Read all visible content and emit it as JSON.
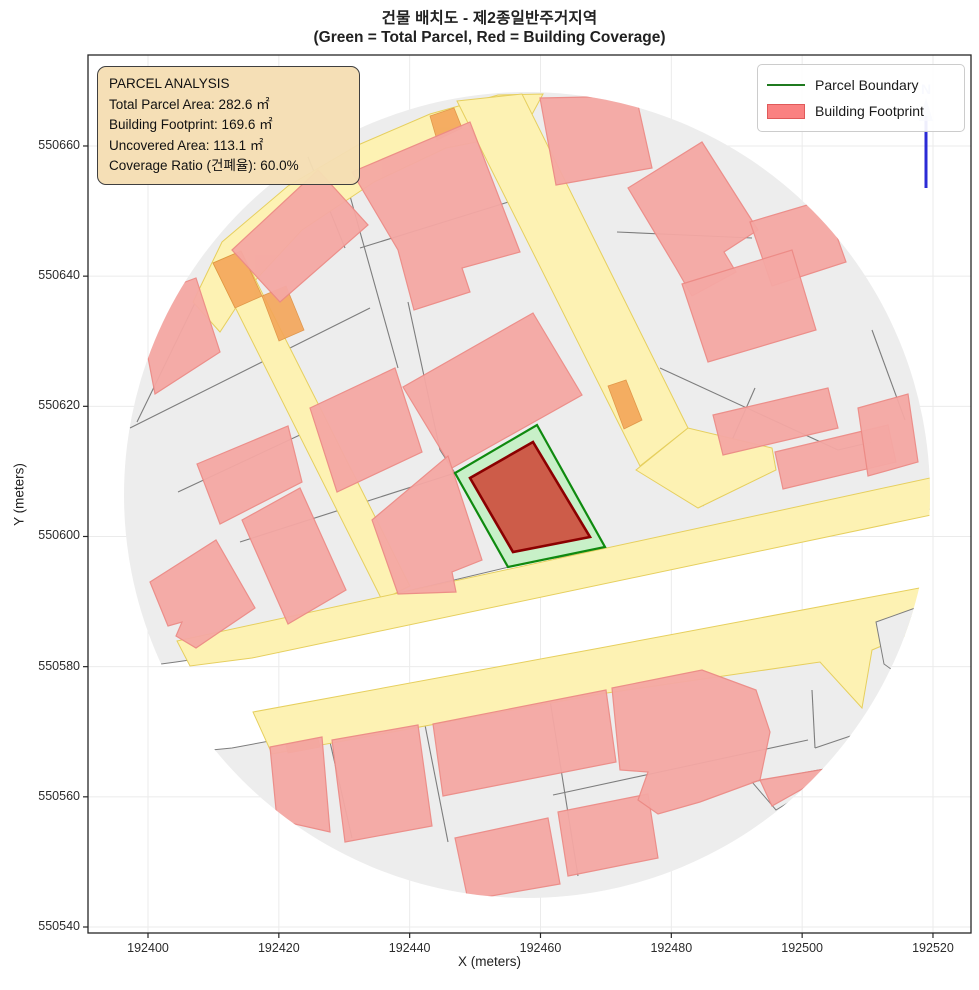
{
  "figure": {
    "title_line1": "건물 배치도 - 제2종일반주거지역",
    "title_line2": "(Green = Total Parcel, Red = Building Coverage)",
    "xlabel": "X (meters)",
    "ylabel": "Y (meters)"
  },
  "legend": {
    "items": [
      {
        "label": "Parcel Boundary",
        "swatch": "green-line"
      },
      {
        "label": "Building Footprint",
        "swatch": "red-patch"
      }
    ]
  },
  "info_box": {
    "title": "PARCEL ANALYSIS",
    "lines": [
      "Total Parcel Area: 282.6 ㎡",
      "Building Footprint: 169.6 ㎡",
      "Uncovered Area: 113.1 ㎡",
      "Coverage Ratio (건폐율): 60.0%"
    ]
  },
  "north_arrow": {
    "label": "N"
  },
  "chart_data": {
    "type": "map",
    "title": "건물 배치도 - 제2종일반주거지역",
    "subtitle": "(Green = Total Parcel, Red = Building Coverage)",
    "xlabel": "X (meters)",
    "ylabel": "Y (meters)",
    "x_ticks": [
      192400,
      192420,
      192440,
      192460,
      192480,
      192500,
      192520
    ],
    "y_ticks": [
      550540,
      550560,
      550580,
      550600,
      550620,
      550640,
      550660
    ],
    "xlim": [
      192391,
      192526
    ],
    "ylim": [
      550539,
      550674
    ],
    "grid": true,
    "legend_position": "upper right",
    "analysis": {
      "total_parcel_area_m2": 282.6,
      "building_footprint_m2": 169.6,
      "uncovered_area_m2": 113.1,
      "coverage_ratio_pct": 60.0,
      "zone": "제2종일반주거지역"
    },
    "map_region": {
      "center_m": [
        192458,
        550606
      ],
      "radius_m": 61.7
    },
    "highlight": {
      "parcel_polygon_m": [
        [
          192459.5,
          550616.9
        ],
        [
          192469.9,
          550598.2
        ],
        [
          192455.1,
          550595.2
        ],
        [
          192447.0,
          550609.6
        ]
      ],
      "building_polygon_m": [
        [
          192458.9,
          550614.3
        ],
        [
          192467.6,
          550599.8
        ],
        [
          192455.9,
          550597.5
        ],
        [
          192449.3,
          550608.8
        ]
      ]
    },
    "style": {
      "building_fill": "#f5a8a4",
      "building_edge": "#ec8a85",
      "parcel_fill": "#ededed",
      "parcel_edge": "#7d7d7d",
      "road_fill": "#fdf2b3",
      "road_edge": "#e6cf5e",
      "orange_fill": "#f4a659",
      "orange_edge": "#de8f3f",
      "highlight_parcel_fill": "#c8f0c8",
      "highlight_parcel_edge": "#0f8a0f",
      "highlight_building_fill": "#cd5c49",
      "highlight_building_edge": "#8b0000",
      "grid_color": "#ebebeb",
      "frame_color": "#262626",
      "north_arrow_color": "#2b2bd6",
      "north_head_color": "#a9b0ea",
      "infobox_bg": "#f5deb3"
    },
    "map_layers": {
      "clip_circle": {
        "cx": 527,
        "cy": 495,
        "r": 403
      },
      "gray_blocks": [
        [
          [
            88,
            60
          ],
          [
            971,
            60
          ],
          [
            971,
            505
          ],
          [
            745,
            528
          ],
          [
            530,
            562
          ],
          [
            395,
            594
          ],
          [
            258,
            650
          ],
          [
            176,
            662
          ],
          [
            88,
            674
          ]
        ],
        [
          [
            232,
            748
          ],
          [
            480,
            702
          ],
          [
            700,
            662
          ],
          [
            935,
            612
          ],
          [
            971,
            604
          ],
          [
            971,
            930
          ],
          [
            88,
            930
          ],
          [
            88,
            762
          ]
        ]
      ],
      "parcel_lines": [
        [
          [
            130,
            428
          ],
          [
            370,
            308
          ]
        ],
        [
          [
            178,
            492
          ],
          [
            302,
            434
          ]
        ],
        [
          [
            240,
            542
          ],
          [
            455,
            473
          ]
        ],
        [
          [
            360,
            248
          ],
          [
            560,
            186
          ]
        ],
        [
          [
            345,
            178
          ],
          [
            398,
            368
          ]
        ],
        [
          [
            408,
            302
          ],
          [
            440,
            450
          ]
        ],
        [
          [
            440,
            450
          ],
          [
            455,
            473
          ]
        ],
        [
          [
            306,
            152
          ],
          [
            345,
            248
          ]
        ],
        [
          [
            137,
            422
          ],
          [
            214,
            264
          ]
        ],
        [
          [
            617,
            232
          ],
          [
            752,
            238
          ]
        ],
        [
          [
            660,
            368
          ],
          [
            838,
            450
          ]
        ],
        [
          [
            755,
            388
          ],
          [
            703,
            506
          ]
        ],
        [
          [
            838,
            450
          ],
          [
            872,
            442
          ]
        ],
        [
          [
            872,
            330
          ],
          [
            905,
            420
          ]
        ],
        [
          [
            330,
            742
          ],
          [
            352,
            838
          ]
        ],
        [
          [
            425,
            725
          ],
          [
            448,
            842
          ]
        ],
        [
          [
            550,
            700
          ],
          [
            578,
            876
          ]
        ],
        [
          [
            553,
            795
          ],
          [
            808,
            740
          ]
        ],
        [
          [
            812,
            690
          ],
          [
            815,
            748
          ]
        ],
        [
          [
            815,
            748
          ],
          [
            883,
            725
          ]
        ]
      ],
      "roads": [
        [
          [
            193,
            302
          ],
          [
            222,
            242
          ],
          [
            288,
            186
          ],
          [
            358,
            145
          ],
          [
            430,
            114
          ],
          [
            498,
            95
          ],
          [
            543,
            94
          ],
          [
            522,
            133
          ],
          [
            446,
            148
          ],
          [
            374,
            182
          ],
          [
            302,
            230
          ],
          [
            250,
            286
          ],
          [
            220,
            332
          ]
        ],
        [
          [
            213,
            263
          ],
          [
            241,
            251
          ],
          [
            410,
            586
          ],
          [
            382,
            600
          ]
        ],
        [
          [
            457,
            101
          ],
          [
            522,
            94
          ],
          [
            688,
            428
          ],
          [
            640,
            466
          ]
        ],
        [
          [
            636,
            470
          ],
          [
            688,
            428
          ],
          [
            772,
            448
          ],
          [
            776,
            470
          ],
          [
            698,
            508
          ]
        ],
        [
          [
            177,
            641
          ],
          [
            930,
            478
          ],
          [
            936,
            514
          ],
          [
            252,
            658
          ],
          [
            190,
            666
          ]
        ],
        [
          [
            253,
            712
          ],
          [
            600,
            648
          ],
          [
            930,
            586
          ],
          [
            934,
            624
          ],
          [
            872,
            650
          ],
          [
            862,
            708
          ],
          [
            820,
            662
          ],
          [
            600,
            694
          ],
          [
            272,
            754
          ]
        ]
      ],
      "orange_segments": [
        [
          [
            213,
            263
          ],
          [
            241,
            251
          ],
          [
            262,
            296
          ],
          [
            235,
            308
          ]
        ],
        [
          [
            262,
            296
          ],
          [
            286,
            286
          ],
          [
            304,
            330
          ],
          [
            279,
            341
          ]
        ],
        [
          [
            608,
            386
          ],
          [
            626,
            380
          ],
          [
            642,
            420
          ],
          [
            624,
            429
          ]
        ],
        [
          [
            430,
            116
          ],
          [
            454,
            108
          ],
          [
            462,
            128
          ],
          [
            437,
            140
          ]
        ],
        [
          [
            286,
            745
          ],
          [
            318,
            739
          ],
          [
            320,
            747
          ],
          [
            288,
            753
          ]
        ]
      ],
      "gray_patches": [
        [
          [
            876,
            622
          ],
          [
            932,
            602
          ],
          [
            934,
            700
          ],
          [
            884,
            664
          ]
        ],
        [
          [
            752,
            782
          ],
          [
            852,
            764
          ],
          [
            776,
            810
          ]
        ]
      ],
      "buildings": [
        [
          [
            232,
            250
          ],
          [
            318,
            170
          ],
          [
            368,
            225
          ],
          [
            280,
            302
          ]
        ],
        [
          [
            352,
            172
          ],
          [
            470,
            122
          ],
          [
            520,
            252
          ],
          [
            462,
            268
          ],
          [
            470,
            292
          ],
          [
            414,
            310
          ],
          [
            398,
            250
          ]
        ],
        [
          [
            540,
            98
          ],
          [
            636,
            96
          ],
          [
            652,
            168
          ],
          [
            556,
            185
          ]
        ],
        [
          [
            628,
            188
          ],
          [
            702,
            142
          ],
          [
            758,
            230
          ],
          [
            724,
            252
          ],
          [
            736,
            272
          ],
          [
            692,
            296
          ],
          [
            676,
            268
          ]
        ],
        [
          [
            750,
            222
          ],
          [
            824,
            200
          ],
          [
            846,
            262
          ],
          [
            772,
            286
          ]
        ],
        [
          [
            682,
            284
          ],
          [
            792,
            250
          ],
          [
            816,
            330
          ],
          [
            708,
            362
          ]
        ],
        [
          [
            713,
            415
          ],
          [
            828,
            388
          ],
          [
            838,
            428
          ],
          [
            723,
            455
          ]
        ],
        [
          [
            775,
            452
          ],
          [
            888,
            425
          ],
          [
            896,
            462
          ],
          [
            783,
            489
          ]
        ],
        [
          [
            858,
            408
          ],
          [
            908,
            394
          ],
          [
            918,
            462
          ],
          [
            868,
            476
          ]
        ],
        [
          [
            137,
            300
          ],
          [
            196,
            278
          ],
          [
            220,
            352
          ],
          [
            155,
            394
          ]
        ],
        [
          [
            150,
            582
          ],
          [
            216,
            540
          ],
          [
            255,
            608
          ],
          [
            196,
            648
          ],
          [
            176,
            636
          ],
          [
            182,
            622
          ],
          [
            168,
            626
          ]
        ],
        [
          [
            197,
            464
          ],
          [
            288,
            426
          ],
          [
            302,
            482
          ],
          [
            220,
            524
          ]
        ],
        [
          [
            242,
            520
          ],
          [
            300,
            488
          ],
          [
            346,
            590
          ],
          [
            288,
            624
          ]
        ],
        [
          [
            310,
            408
          ],
          [
            395,
            368
          ],
          [
            422,
            452
          ],
          [
            337,
            492
          ]
        ],
        [
          [
            403,
            387
          ],
          [
            533,
            313
          ],
          [
            582,
            395
          ],
          [
            452,
            468
          ]
        ],
        [
          [
            372,
            520
          ],
          [
            448,
            456
          ],
          [
            482,
            560
          ],
          [
            452,
            572
          ],
          [
            456,
            592
          ],
          [
            398,
            594
          ]
        ],
        [
          [
            270,
            747
          ],
          [
            322,
            737
          ],
          [
            330,
            832
          ],
          [
            277,
            820
          ]
        ],
        [
          [
            332,
            740
          ],
          [
            418,
            725
          ],
          [
            432,
            826
          ],
          [
            345,
            842
          ]
        ],
        [
          [
            433,
            724
          ],
          [
            606,
            690
          ],
          [
            616,
            762
          ],
          [
            443,
            796
          ]
        ],
        [
          [
            455,
            838
          ],
          [
            548,
            818
          ],
          [
            560,
            884
          ],
          [
            468,
            900
          ]
        ],
        [
          [
            558,
            812
          ],
          [
            648,
            794
          ],
          [
            658,
            858
          ],
          [
            568,
            876
          ]
        ],
        [
          [
            612,
            688
          ],
          [
            702,
            670
          ],
          [
            756,
            690
          ],
          [
            770,
            732
          ],
          [
            760,
            780
          ],
          [
            700,
            802
          ],
          [
            658,
            814
          ],
          [
            638,
            800
          ],
          [
            648,
            772
          ],
          [
            620,
            770
          ]
        ],
        [
          [
            760,
            780
          ],
          [
            843,
            766
          ],
          [
            772,
            806
          ]
        ]
      ],
      "highlight_parcel_px": [
        [
          537,
          425
        ],
        [
          605,
          547
        ],
        [
          508,
          567
        ],
        [
          455,
          473
        ]
      ],
      "highlight_building_px": [
        [
          533,
          442
        ],
        [
          590,
          537
        ],
        [
          513,
          552
        ],
        [
          470,
          478
        ]
      ],
      "north_arrow_px": {
        "x": 926,
        "y_top": 116,
        "y_bottom": 188
      }
    }
  }
}
